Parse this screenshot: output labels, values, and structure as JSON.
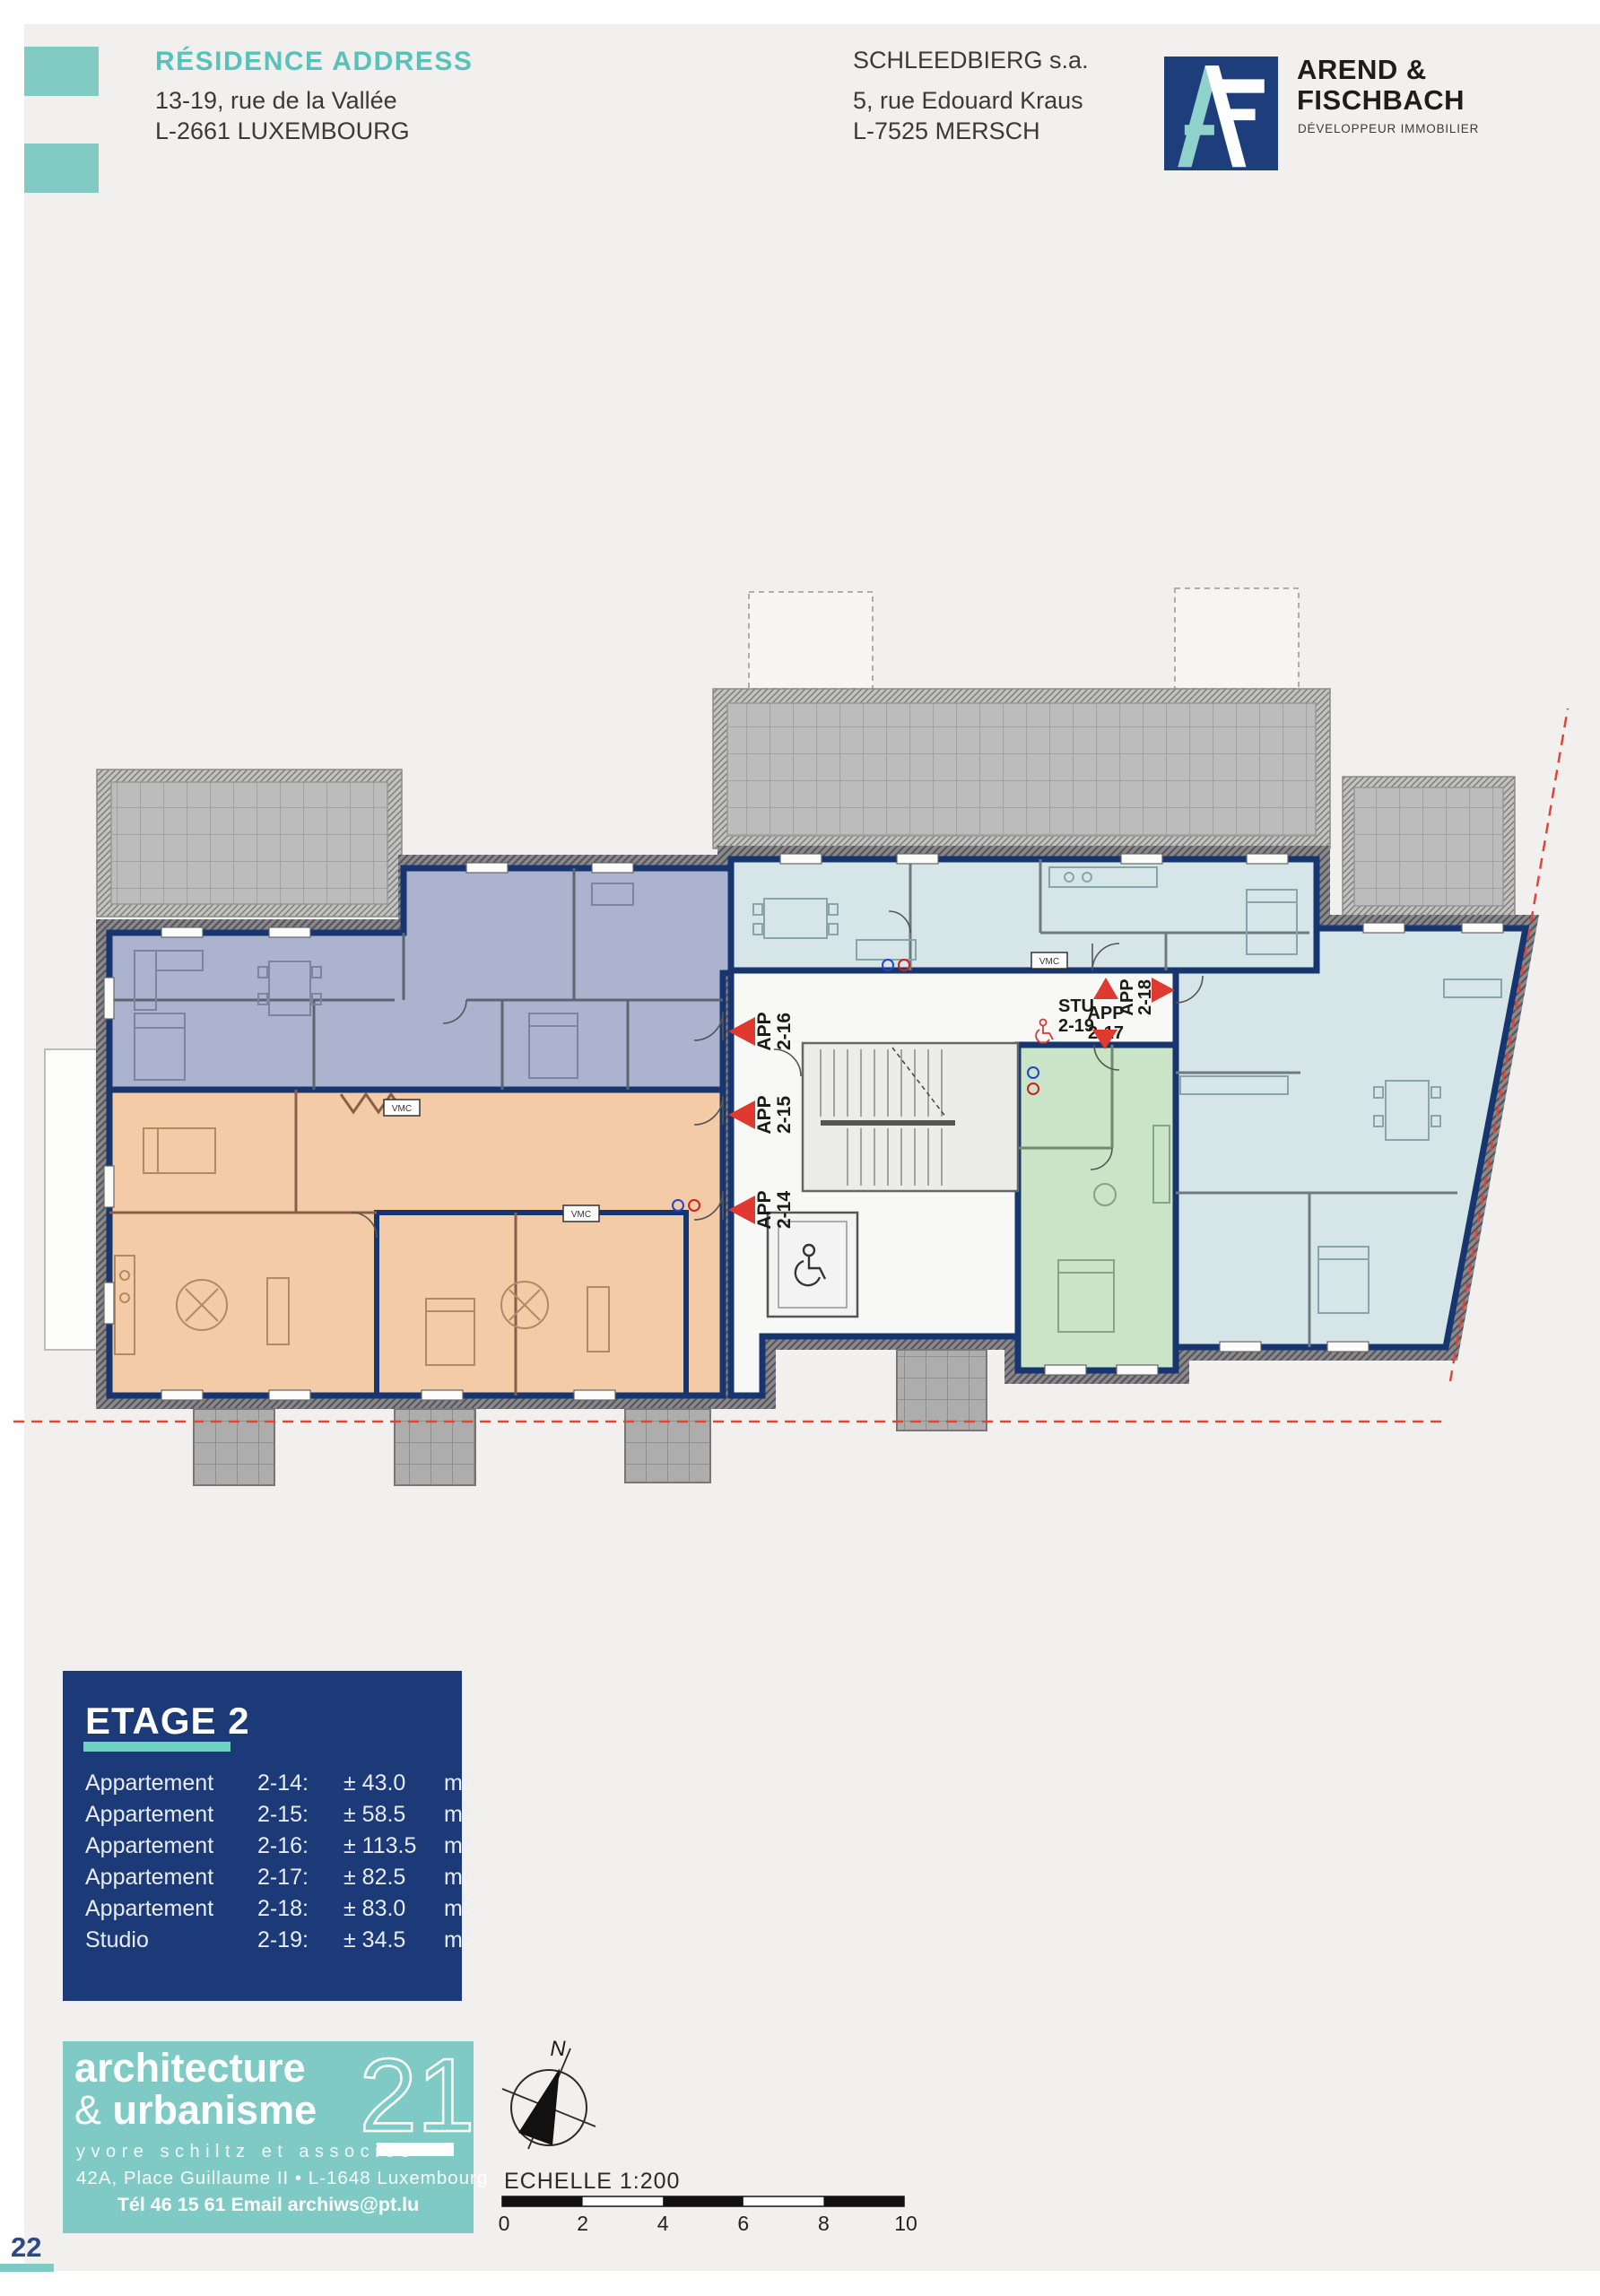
{
  "header": {
    "title": "RÉSIDENCE ADDRESS",
    "address_line1": "13-19, rue de la Vallée",
    "address_line2": "L-2661 LUXEMBOURG",
    "developer_name": "SCHLEEDBIERG s.a.",
    "developer_address1": "5, rue Edouard Kraus",
    "developer_address2": "L-7525 MERSCH",
    "brand": {
      "name_line1": "AREND &",
      "name_line2": "FISCHBACH",
      "tagline": "DÉVELOPPEUR IMMOBILIER"
    }
  },
  "floor_info": {
    "title": "ETAGE 2",
    "units": [
      {
        "type": "Appartement",
        "number": "2-14:",
        "area": "± 43.0",
        "unit": "m²"
      },
      {
        "type": "Appartement",
        "number": "2-15:",
        "area": "± 58.5",
        "unit": "m²"
      },
      {
        "type": "Appartement",
        "number": "2-16:",
        "area": "± 113.5",
        "unit": "m²"
      },
      {
        "type": "Appartement",
        "number": "2-17:",
        "area": "± 82.5",
        "unit": "m²"
      },
      {
        "type": "Appartement",
        "number": "2-18:",
        "area": "± 83.0",
        "unit": "m²"
      },
      {
        "type": "Studio",
        "number": "2-19:",
        "area": "± 34.5",
        "unit": "m²"
      }
    ]
  },
  "plan": {
    "markers": {
      "app_2_14": [
        "APP",
        "2-14"
      ],
      "app_2_15": [
        "APP",
        "2-15"
      ],
      "app_2_16": [
        "APP",
        "2-16"
      ],
      "app_2_17": [
        "APP",
        "2-17"
      ],
      "app_2_18": [
        "APP",
        "2-18"
      ],
      "stu_2_19": [
        "STU",
        "2-19"
      ]
    },
    "vmc_label": "VMC"
  },
  "compass": {
    "north_label": "N"
  },
  "scale_bar": {
    "label": "ECHELLE 1:200",
    "ticks": [
      "0",
      "2",
      "4",
      "6",
      "8",
      "10"
    ]
  },
  "studio_logo": {
    "line1": "architecture",
    "amp": "&",
    "line2": "urbanisme",
    "number": "21",
    "subtitle": "yvore schiltz et associés",
    "address": "42A, Place Guillaume II  •  L-1648 Luxembourg",
    "contact": "Tél 46 15 61 Email archiws@pt.lu"
  },
  "page": {
    "number": "22"
  }
}
